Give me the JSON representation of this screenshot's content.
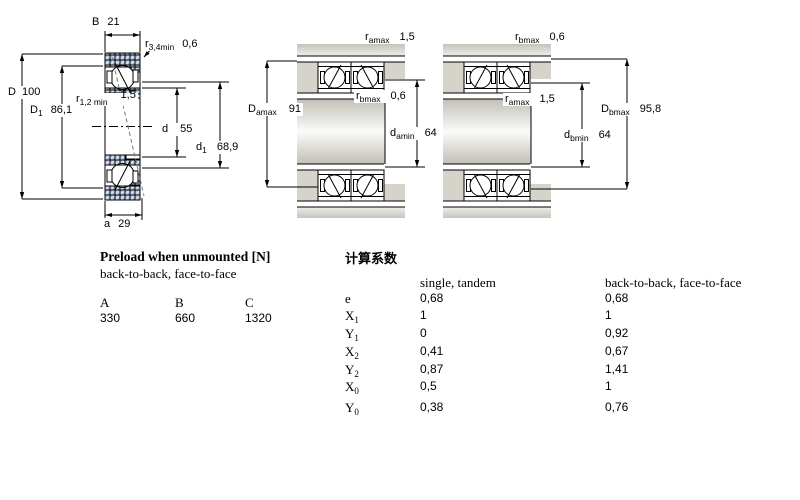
{
  "dims": {
    "B": {
      "sym": "B",
      "sub": "",
      "value": "21"
    },
    "r34": {
      "sym": "r",
      "sub": "3,4min",
      "value": "0,6"
    },
    "D": {
      "sym": "D",
      "sub": "",
      "value": "100"
    },
    "r12": {
      "sym": "r",
      "sub": "1,2 min",
      "value": "1,5"
    },
    "D1": {
      "sym": "D",
      "sub": "1",
      "value": "86,1"
    },
    "d": {
      "sym": "d",
      "sub": "",
      "value": "55"
    },
    "d1": {
      "sym": "d",
      "sub": "1",
      "value": "68,9"
    },
    "a": {
      "sym": "a",
      "sub": "",
      "value": "29"
    },
    "ramax_m": {
      "sym": "r",
      "sub": "amax",
      "value": "1,5"
    },
    "rbmax_m": {
      "sym": "r",
      "sub": "bmax",
      "value": "0,6"
    },
    "Damax": {
      "sym": "D",
      "sub": "amax",
      "value": "91"
    },
    "damin": {
      "sym": "d",
      "sub": "amin",
      "value": "64"
    },
    "rbmax_r": {
      "sym": "r",
      "sub": "bmax",
      "value": "0,6"
    },
    "ramax_r": {
      "sym": "r",
      "sub": "amax",
      "value": "1,5"
    },
    "Dbmax": {
      "sym": "D",
      "sub": "bmax",
      "value": "95,8"
    },
    "dbmin": {
      "sym": "d",
      "sub": "bmin",
      "value": "64"
    }
  },
  "preload": {
    "title": "Preload when unmounted [N]",
    "subtitle": "back-to-back, face-to-face",
    "columns": [
      "A",
      "B",
      "C"
    ],
    "values": [
      "330",
      "660",
      "1320"
    ]
  },
  "factors": {
    "title": "计算系数",
    "col_single": "single, tandem",
    "col_pair": "back-to-back, face-to-face",
    "rows": [
      {
        "sym": "e",
        "sub": "",
        "single": "0,68",
        "pair": "0,68"
      },
      {
        "sym": "X",
        "sub": "1",
        "single": "1",
        "pair": "1"
      },
      {
        "sym": "Y",
        "sub": "1",
        "single": "0",
        "pair": "0,92"
      },
      {
        "sym": "X",
        "sub": "2",
        "single": "0,41",
        "pair": "0,67"
      },
      {
        "sym": "Y",
        "sub": "2",
        "single": "0,87",
        "pair": "1,41"
      },
      {
        "sym": "X",
        "sub": "0",
        "single": "0,5",
        "pair": "1"
      },
      {
        "sym": "Y",
        "sub": "0",
        "single": "0,38",
        "pair": "0,76"
      }
    ]
  },
  "colors": {
    "ring_blue": "#ccdaee",
    "housing_gray": "#cbc8c0"
  }
}
